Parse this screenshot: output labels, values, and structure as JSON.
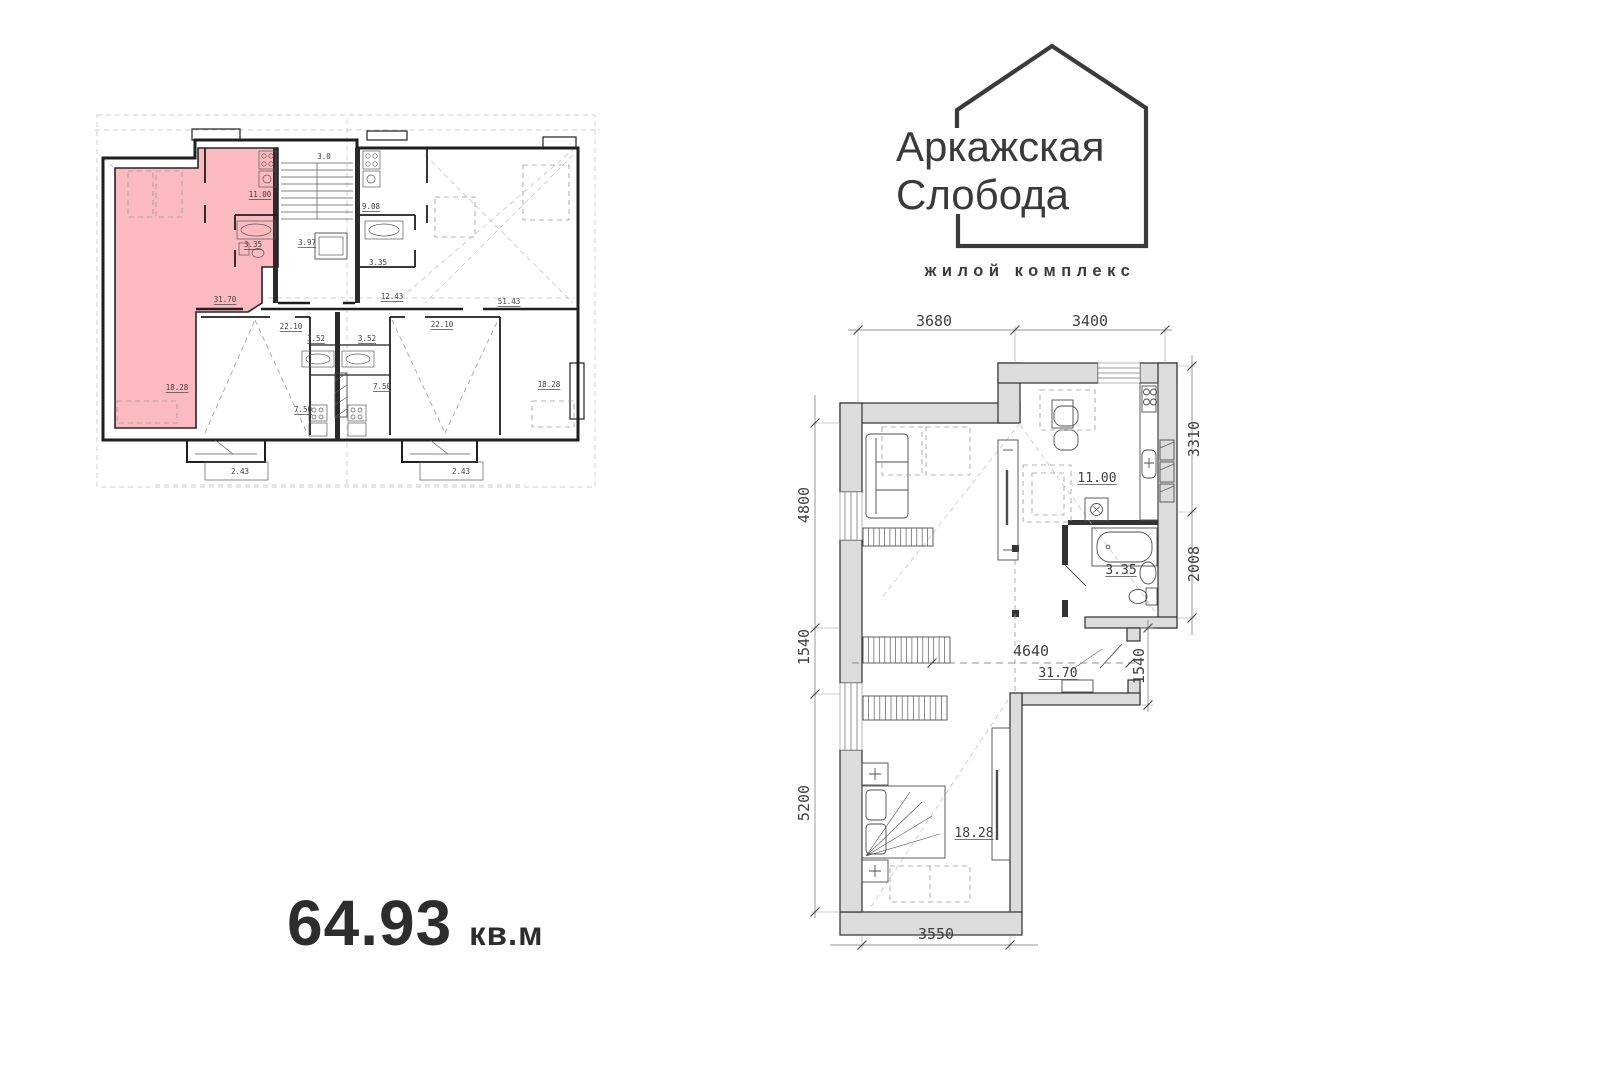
{
  "logo": {
    "line1": "Аркажская",
    "line2": "Слобода",
    "subtitle": "жилой комплекс"
  },
  "area": {
    "value": "64.93",
    "unit": "кв.м"
  },
  "colors": {
    "highlight": "#fbb9c0",
    "wall_fill": "#dcdcdc",
    "ink": "#2e2e2e",
    "logo_ink": "#3a3a3a",
    "cad_text": "#3f3f3f"
  },
  "overview": {
    "labels": [
      {
        "t": "3.0",
        "x": 229,
        "y": 54
      },
      {
        "t": "11.00",
        "x": 165,
        "y": 92,
        "u": 1
      },
      {
        "t": "3.35",
        "x": 158,
        "y": 142,
        "u": 1
      },
      {
        "t": "3.97",
        "x": 212,
        "y": 140,
        "u": 1
      },
      {
        "t": "9.08",
        "x": 276,
        "y": 104,
        "u": 1
      },
      {
        "t": "3.35",
        "x": 283,
        "y": 160,
        "u": 1
      },
      {
        "t": "31.70",
        "x": 130,
        "y": 197,
        "u": 1
      },
      {
        "t": "12.43",
        "x": 297,
        "y": 194,
        "u": 1
      },
      {
        "t": "51.43",
        "x": 414,
        "y": 199,
        "u": 1
      },
      {
        "t": "22.10",
        "x": 196,
        "y": 224,
        "u": 1
      },
      {
        "t": "22.10",
        "x": 347,
        "y": 222,
        "u": 1
      },
      {
        "t": "3.52",
        "x": 221,
        "y": 236,
        "u": 1
      },
      {
        "t": "3.52",
        "x": 272,
        "y": 236,
        "u": 1
      },
      {
        "t": "7.50",
        "x": 208,
        "y": 307,
        "u": 1
      },
      {
        "t": "7.50",
        "x": 287,
        "y": 284,
        "u": 1
      },
      {
        "t": "18.28",
        "x": 82,
        "y": 285,
        "u": 1
      },
      {
        "t": "18.28",
        "x": 454,
        "y": 282,
        "u": 1
      },
      {
        "t": "2.43",
        "x": 145,
        "y": 369
      },
      {
        "t": "2.43",
        "x": 366,
        "y": 369
      }
    ]
  },
  "detailed": {
    "labels": [
      {
        "t": "3680",
        "x": 164,
        "y": 26,
        "s": 15
      },
      {
        "t": "3400",
        "x": 320,
        "y": 26,
        "s": 15
      },
      {
        "t": "4800",
        "x": 39,
        "y": 205,
        "r": -90,
        "s": 15
      },
      {
        "t": "1540",
        "x": 39,
        "y": 347,
        "r": -90,
        "s": 15
      },
      {
        "t": "5200",
        "x": 39,
        "y": 503,
        "r": -90,
        "s": 15
      },
      {
        "t": "3310",
        "x": 429,
        "y": 139,
        "r": -90,
        "s": 15
      },
      {
        "t": "2008",
        "x": 429,
        "y": 264,
        "r": -90,
        "s": 15
      },
      {
        "t": "1540",
        "x": 374,
        "y": 366,
        "r": -90,
        "s": 15
      },
      {
        "t": "3550",
        "x": 166,
        "y": 639,
        "s": 15
      },
      {
        "t": "4640",
        "x": 261,
        "y": 356,
        "s": 15
      },
      {
        "t": "31.70",
        "x": 288,
        "y": 377,
        "u": 1,
        "s": 13
      },
      {
        "t": "11.00",
        "x": 327,
        "y": 182,
        "u": 1,
        "s": 13
      },
      {
        "t": "3.35",
        "x": 351,
        "y": 274,
        "u": 1,
        "s": 13
      },
      {
        "t": "18.28",
        "x": 204,
        "y": 537,
        "u": 1,
        "s": 13
      }
    ]
  }
}
